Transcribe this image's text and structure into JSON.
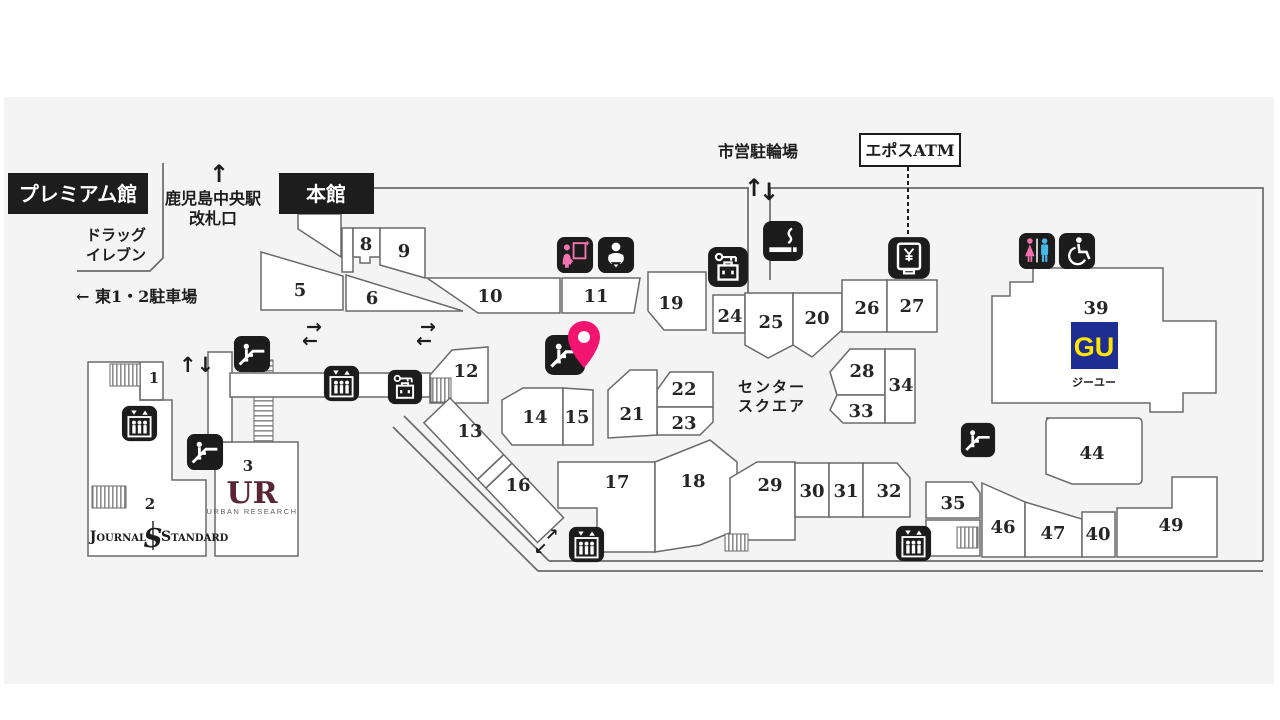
{
  "map": {
    "premium_label": "プレミアム館",
    "main_label": "本館",
    "station_line1": "鹿児島中央駅",
    "station_line2": "改札口",
    "drug_line1": "ドラッグ",
    "drug_line2": "イレブン",
    "east_parking": "← 東1・2駐車場",
    "bicycle_parking": "市営駐輪場",
    "epos_atm": "エポスATM",
    "center_square_line1": "センター",
    "center_square_line2": "スクエア",
    "arrows": {
      "up": "↑",
      "down": "↓",
      "right": "→",
      "left": "←",
      "ne": "↗",
      "sw": "↙",
      "up_down": "↑↓"
    },
    "stores": {
      "gu": {
        "logo": "GU",
        "name": "ジーユー"
      },
      "urban_research": {
        "logo": "UR",
        "name": "URBAN RESEARCH"
      },
      "journal_standard": {
        "left": "Journal",
        "monogram": "S",
        "right": "Standard"
      }
    },
    "areas": {
      "a1": "1",
      "a2": "2",
      "a3": "3",
      "a5": "5",
      "a6": "6",
      "a8": "8",
      "a9": "9",
      "a10": "10",
      "a11": "11",
      "a12": "12",
      "a13": "13",
      "a14": "14",
      "a15": "15",
      "a16": "16",
      "a17": "17",
      "a18": "18",
      "a19": "19",
      "a20": "20",
      "a21": "21",
      "a22": "22",
      "a23": "23",
      "a24": "24",
      "a25": "25",
      "a26": "26",
      "a27": "27",
      "a28": "28",
      "a29": "29",
      "a30": "30",
      "a31": "31",
      "a32": "32",
      "a33": "33",
      "a34": "34",
      "a35": "35",
      "a39": "39",
      "a40": "40",
      "a44": "44",
      "a46": "46",
      "a47": "47",
      "a49": "49"
    }
  },
  "colors": {
    "background_panel": "#f4f4f4",
    "outline": "#6a6a6a",
    "icon_black": "#1c1c1c",
    "pin_pink": "#f3146f",
    "gu_blue": "#1e2d91",
    "gu_yellow": "#ffe600",
    "toilet_pink": "#f172ac",
    "toilet_blue": "#47b5e6",
    "ur_maroon": "#5a2633"
  }
}
